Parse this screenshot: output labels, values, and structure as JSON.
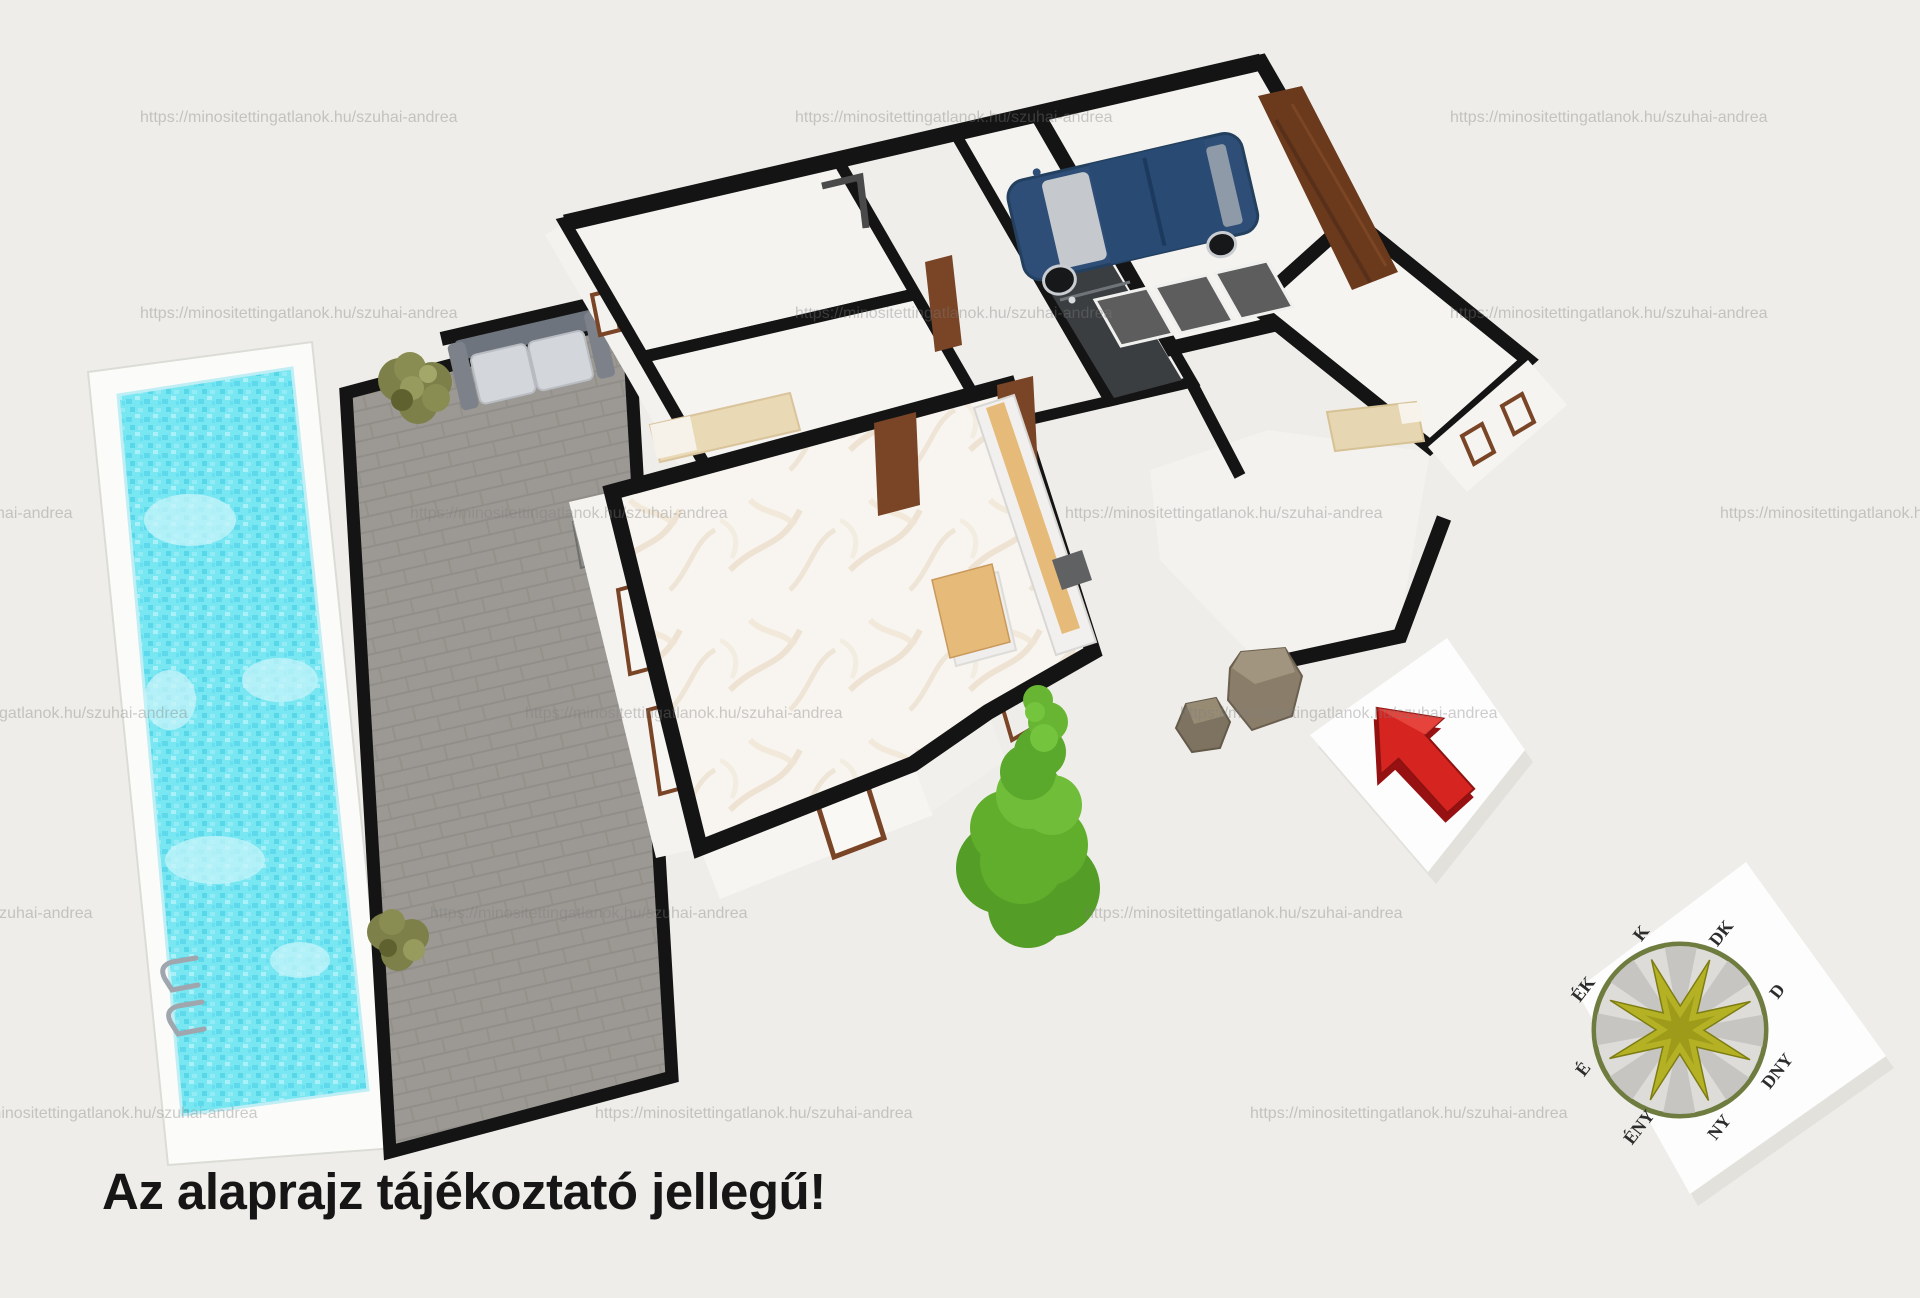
{
  "meta": {
    "type": "3d-floor-plan-render",
    "language": "hu"
  },
  "caption": {
    "text": "Az alaprajz tájékoztató jellegű!"
  },
  "watermark": {
    "url": "https://minositettingatlanok.hu/szuhai-andrea"
  },
  "compass": {
    "labels": [
      "K",
      "DK",
      "D",
      "DNY",
      "NY",
      "ÉNY",
      "É",
      "ÉK"
    ]
  },
  "colors": {
    "background": "#efede9",
    "pool_water": "#79e7f2",
    "pool_deck": "#fbfbf9",
    "terrace_paving": "#9c9994",
    "wall_outline": "#141414",
    "room_floor": "#f5f4f1",
    "marble_floor": "#f8f5f0",
    "door_wood": "#7a4426",
    "garage_door": "#6b3a1c",
    "car_body": "#2e4e78",
    "tree_green": "#61ae2d",
    "bush_olive": "#7d8049",
    "rock_brown": "#8a7e6b",
    "kitchen_wood": "#e6ba78",
    "north_arrow_red": "#d62421",
    "compass_star": "#b4b224",
    "card_white": "#fdfdfd"
  },
  "scene": {
    "elements": [
      "swimming-pool",
      "pool-deck",
      "pool-ladder",
      "terrace",
      "garden-bench",
      "bush",
      "house-walls",
      "bedroom-left",
      "bedroom-left-2",
      "hallway",
      "small-room",
      "bathroom",
      "garage",
      "car",
      "garage-door",
      "floor-mats",
      "bedroom-right",
      "living-room",
      "kitchen-counter",
      "kitchen-island",
      "bed",
      "entrance-porch",
      "tree",
      "rocks",
      "north-arrow-card",
      "compass-card"
    ]
  }
}
